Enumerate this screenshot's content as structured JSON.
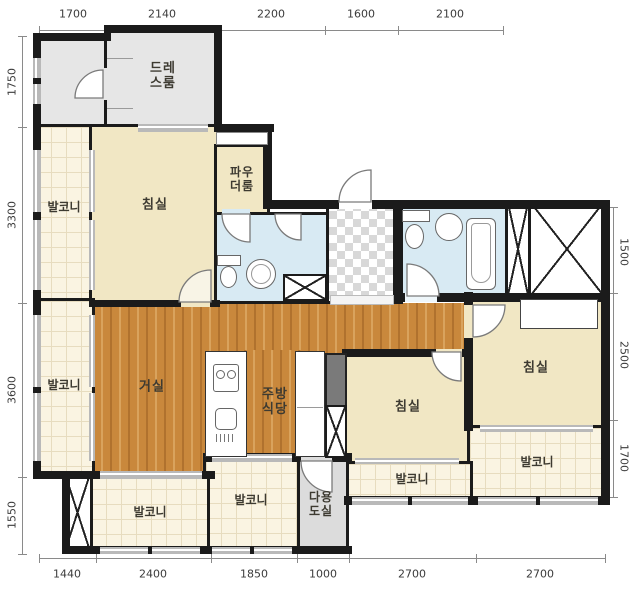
{
  "plan_title": "apartment-floor-plan",
  "colors": {
    "wall": "#1b1b1b",
    "bedroom_fill": "#f1e7c4",
    "balcony_fill": "#faf4e2",
    "wood_floor": "#c9883c",
    "bath_fill": "#d8eaf3",
    "gray_room_fill": "#e6e6e6",
    "utility_fill": "#dcdcdc"
  },
  "rooms": {
    "dress": {
      "line1": "드레",
      "line2": "스룸"
    },
    "powder": {
      "line1": "파우",
      "line2": "더룸"
    },
    "bedroom1": {
      "label": "침실"
    },
    "bedroom2": {
      "label": "침실"
    },
    "bedroom3": {
      "label": "침실"
    },
    "living": {
      "label": "거실"
    },
    "kitchen": {
      "line1": "주방",
      "line2": "식당"
    },
    "utility": {
      "line1": "다용",
      "line2": "도실"
    },
    "balcony_upper_left": {
      "label": "발코니"
    },
    "balcony_lower_left": {
      "label": "발코니"
    },
    "balcony_bottom_a": {
      "label": "발코니"
    },
    "balcony_bottom_b": {
      "label": "발코니"
    },
    "balcony_bottom_c": {
      "label": "발코니"
    },
    "balcony_right": {
      "label": "발코니"
    }
  },
  "dimensions": {
    "top": [
      "1700",
      "2140",
      "2200",
      "1600",
      "2100"
    ],
    "left": [
      "1750",
      "3300",
      "3600",
      "1550"
    ],
    "right": [
      "1500",
      "2500",
      "1700"
    ],
    "bottom": [
      "1440",
      "2400",
      "1850",
      "1000",
      "2700",
      "2700"
    ]
  }
}
